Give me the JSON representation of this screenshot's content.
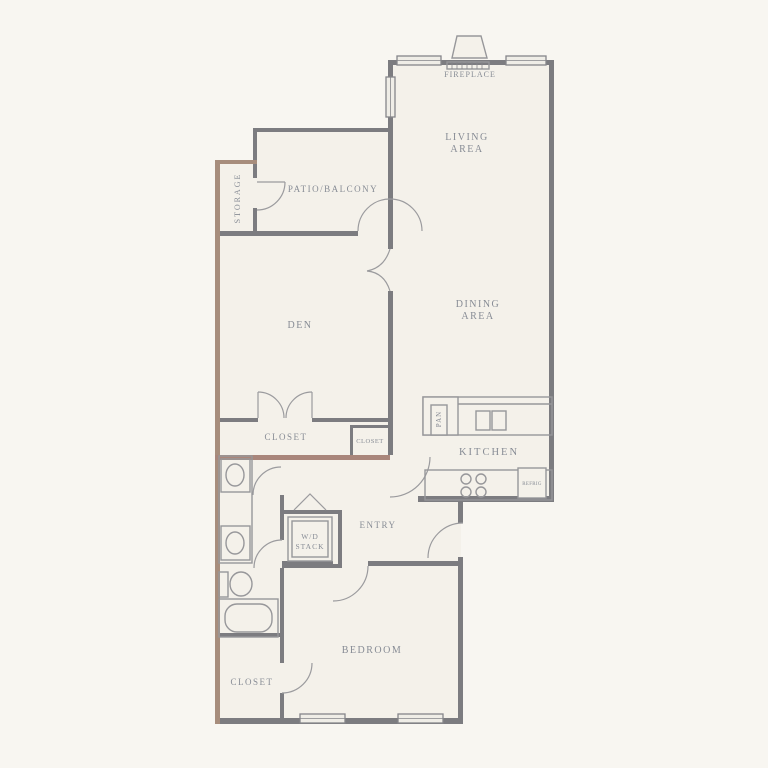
{
  "title": "apartment-floor-plan",
  "labels": {
    "living": [
      "LIVING",
      "AREA"
    ],
    "dining": [
      "DINING",
      "AREA"
    ],
    "fireplace": "FIREPLACE",
    "patio_balcony": "PATIO/BALCONY",
    "storage": "STORAGE",
    "den": "DEN",
    "closet_hall": "CLOSET",
    "closet_hall_small": "CLOSET",
    "kitchen": "KITCHEN",
    "pantry": "PAN",
    "entry": "ENTRY",
    "wd_stack": [
      "W/D",
      "STACK"
    ],
    "bedroom": "BEDROOM",
    "closet_bedroom": "CLOSET",
    "refrigerator": "REFRIG"
  },
  "colors": {
    "background": "#f8f6f1",
    "floor": "#f4f1ea",
    "wall": "#7c7c80",
    "wall_accent_brown": "#a78d7c",
    "wall_accent_red": "#a9867b",
    "fixture_line": "#97979a",
    "window_fill": "#efede7",
    "text": "#878c95"
  },
  "fixtures": {
    "icons": [
      "fireplace-icon",
      "window",
      "door-arc",
      "pantry-icon",
      "kitchen-sink-icon",
      "stove-icon",
      "refrigerator-icon",
      "vanity-sink-icon",
      "toilet-icon",
      "bathtub-icon",
      "washer-dryer-icon",
      "french-doors",
      "bifold-door-icon"
    ],
    "stove_burners": 4,
    "kitchen_sink_basins": 2,
    "vanity_sinks": 2,
    "windows": 5
  }
}
